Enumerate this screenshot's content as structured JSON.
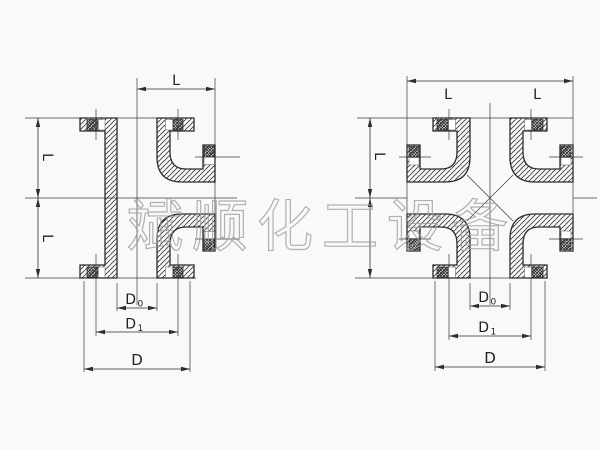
{
  "page": {
    "background": "#f9f9f7",
    "ink_color": "#2b2b2b",
    "hatch_color": "#3d3d3d",
    "watermark": {
      "text": "斌顺化工设备",
      "color": "#9e9e9e"
    }
  },
  "tee_drawing": {
    "labels": {
      "length_top": "L",
      "length_upper": "L",
      "length_lower": "L",
      "bore_dia_base": "D",
      "bore_dia_sub": "0",
      "bolt_circle_base": "D",
      "bolt_circle_sub": "1",
      "flange_dia": "D"
    }
  },
  "cross_drawing": {
    "labels": {
      "length_top_left": "L",
      "length_top_right": "L",
      "length_side": "L",
      "bore_dia_base": "D",
      "bore_dia_sub": "0",
      "bolt_circle_base": "D",
      "bolt_circle_sub": "1",
      "flange_dia": "D"
    }
  }
}
